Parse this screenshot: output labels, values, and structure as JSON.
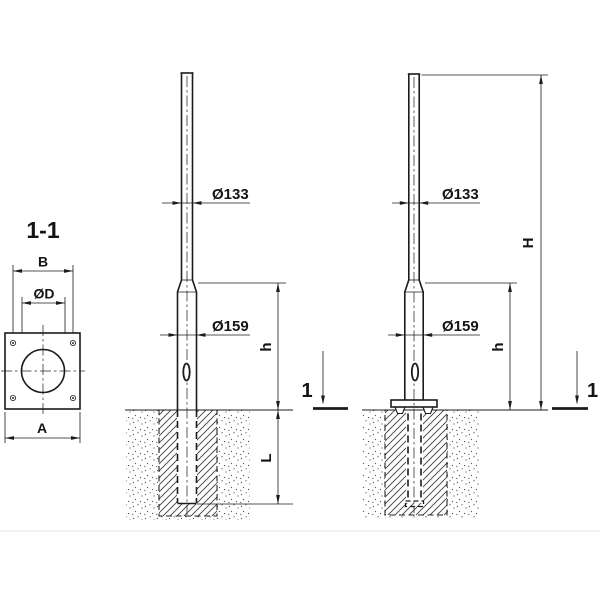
{
  "colors": {
    "ink": "#1b1b1b",
    "bg": "#ffffff"
  },
  "section_view": {
    "label": "1-1",
    "dim_bolt_spacing": "B",
    "dim_hole_diameter": "ØD",
    "dim_plate_width": "A"
  },
  "buried_pole": {
    "dim_top_diameter": "Ø133",
    "dim_base_diameter": "Ø159",
    "dim_above_ground": "h",
    "dim_embedment": "L"
  },
  "flanged_pole": {
    "dim_top_diameter": "Ø133",
    "dim_base_diameter": "Ø159",
    "dim_above_ground": "h",
    "dim_total_height": "H",
    "cut_label": "1"
  }
}
